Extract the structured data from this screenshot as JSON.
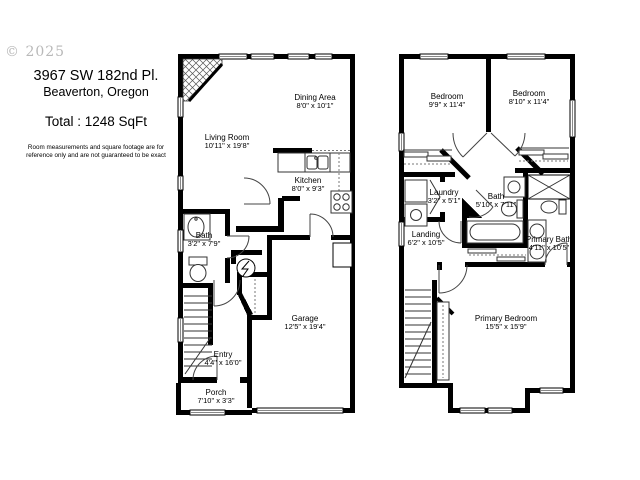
{
  "meta": {
    "watermark": "© 2025"
  },
  "header": {
    "address_line1": "3967 SW 182nd Pl.",
    "address_line2": "Beaverton, Oregon",
    "total_area": "Total : 1248 SqFt",
    "disclaimer_line1": "Room measurements and square footage are for",
    "disclaimer_line2": "reference only and are not guaranteed to be exact"
  },
  "colors": {
    "wall": "#000000",
    "background": "#ffffff",
    "watermark": "#b9b9b9"
  },
  "floors": [
    {
      "name": "first-floor",
      "rooms": [
        {
          "name": "Living Room",
          "dims": "10'11\" x 19'8\""
        },
        {
          "name": "Dining Area",
          "dims": "8'0\" x 10'1\""
        },
        {
          "name": "Kitchen",
          "dims": "8'0\" x 9'3\""
        },
        {
          "name": "Bath",
          "dims": "3'2\" x 7'9\""
        },
        {
          "name": "Garage",
          "dims": "12'5\" x 19'4\""
        },
        {
          "name": "Entry",
          "dims": "4'4\" x 16'0\""
        },
        {
          "name": "Porch",
          "dims": "7'10\" x 3'3\""
        }
      ]
    },
    {
      "name": "second-floor",
      "rooms": [
        {
          "name": "Bedroom",
          "dims": "9'9\" x 11'4\""
        },
        {
          "name": "Bedroom",
          "dims": "8'10\" x 11'4\""
        },
        {
          "name": "Laundry",
          "dims": "3'2\" x 5'1\""
        },
        {
          "name": "Bath",
          "dims": "5'10\" x 7'11\""
        },
        {
          "name": "Landing",
          "dims": "6'2\" x 10'5\""
        },
        {
          "name": "Primary Bath",
          "dims": "4'11\" x 10'5\""
        },
        {
          "name": "Primary Bedroom",
          "dims": "15'5\" x 15'9\""
        }
      ]
    }
  ]
}
